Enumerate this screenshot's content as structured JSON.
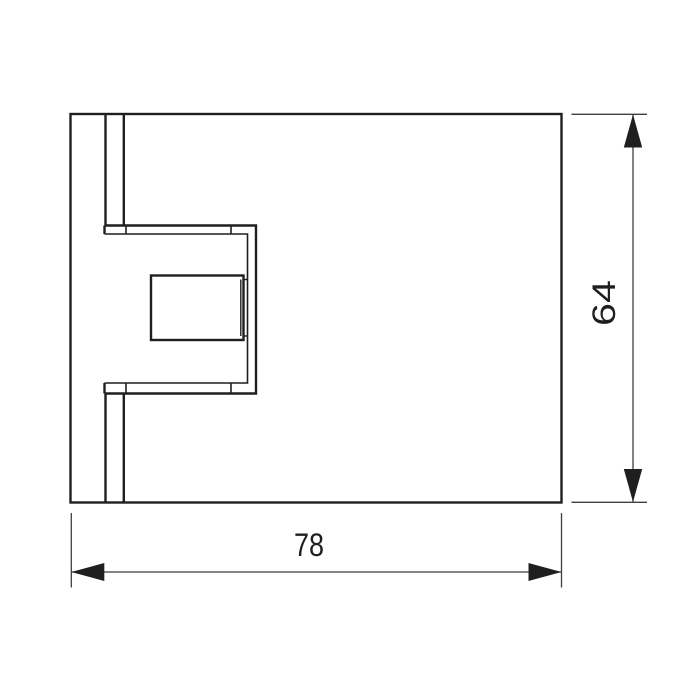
{
  "figure": {
    "background_color": "#ffffff",
    "line_color": "#1f1f1f",
    "dimension_line_color": "#3f3f3f",
    "labels": {
      "width": "78",
      "height": "64"
    }
  }
}
